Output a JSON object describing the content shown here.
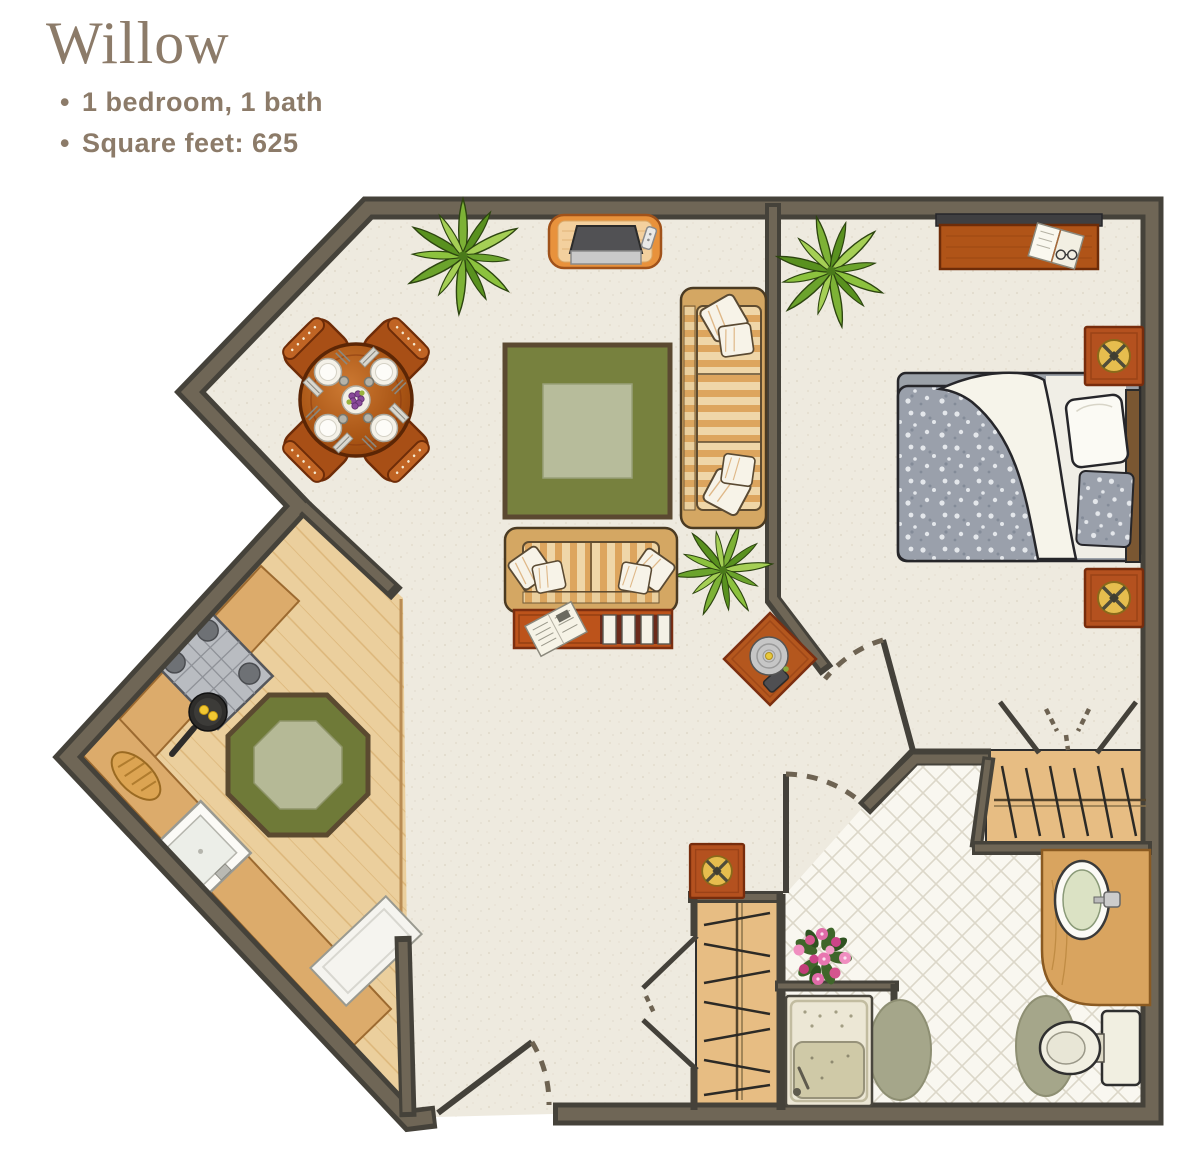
{
  "header": {
    "title": "Willow",
    "bullet": "•",
    "details": [
      "1 bedroom, 1 bath",
      "Square feet: 625"
    ],
    "text_color": "#8c7b69"
  },
  "floor_plan": {
    "unit_name": "Willow",
    "bedrooms": 1,
    "bathrooms": 1,
    "square_feet": 625,
    "rooms": [
      {
        "name": "living-dining-area",
        "floor": "carpet"
      },
      {
        "name": "kitchen",
        "floor": "hardwood"
      },
      {
        "name": "bedroom",
        "floor": "carpet"
      },
      {
        "name": "bathroom",
        "floor": "tile"
      },
      {
        "name": "bedroom-closet",
        "floor": "hardwood"
      },
      {
        "name": "entry-closet",
        "floor": "hardwood"
      },
      {
        "name": "entry-hallway",
        "floor": "carpet"
      }
    ],
    "doors": [
      "entry-door-swing",
      "bedroom-door-swing",
      "bathroom-door-swing",
      "entry-closet-bifold",
      "bedroom-closet-bifold"
    ],
    "furniture": [
      "round-dining-table",
      "dining-chairs-x4",
      "place-settings-x4",
      "center-fruit-plate",
      "square-green-area-rug",
      "striped-sofa",
      "striped-loveseat",
      "coffee-table-with-newspaper-and-magazines",
      "tv-stand-with-television-and-remote",
      "potted-plant-living",
      "potted-plant-by-sofa",
      "potted-plant-bedroom",
      "side-table-with-record-player",
      "bed-with-gray-comforter",
      "white-pillow",
      "headboard",
      "dresser-with-open-book",
      "nightstand-flower-top-x2",
      "hallway-accent-table-flower-top",
      "stove-4-burners",
      "frying-pan-with-eggs",
      "kitchen-sink",
      "bread-loaf",
      "white-counter-appliance",
      "octagonal-green-rug",
      "closet-rod-with-hangers-x2",
      "bathroom-vanity-with-sink",
      "toilet",
      "walk-in-shower-with-seat",
      "oval-bath-mats-x2",
      "pink-flower-bouquet"
    ],
    "colors": {
      "wall_fill": "#6f6656",
      "wall_outline": "#45423a",
      "carpet": "#eeeadf",
      "hardwood": "#ebcf9d",
      "closet_wood": "#e7bd83",
      "tile": "#f9f7f0",
      "rug_green": "#77813e",
      "rug_center": "#b7bc9b",
      "furniture_wood": "#b2571c",
      "sofa_stripe_light": "#efd6a8",
      "sofa_stripe_dark": "#dda55e",
      "accent_red": "#b4511f",
      "flower_gold": "#e6bd4e",
      "comforter_gray": "#9aa0ab",
      "plant_green": "#7db236",
      "bath_fixture": "#f1efe1",
      "title_text": "#8c7b69"
    }
  }
}
